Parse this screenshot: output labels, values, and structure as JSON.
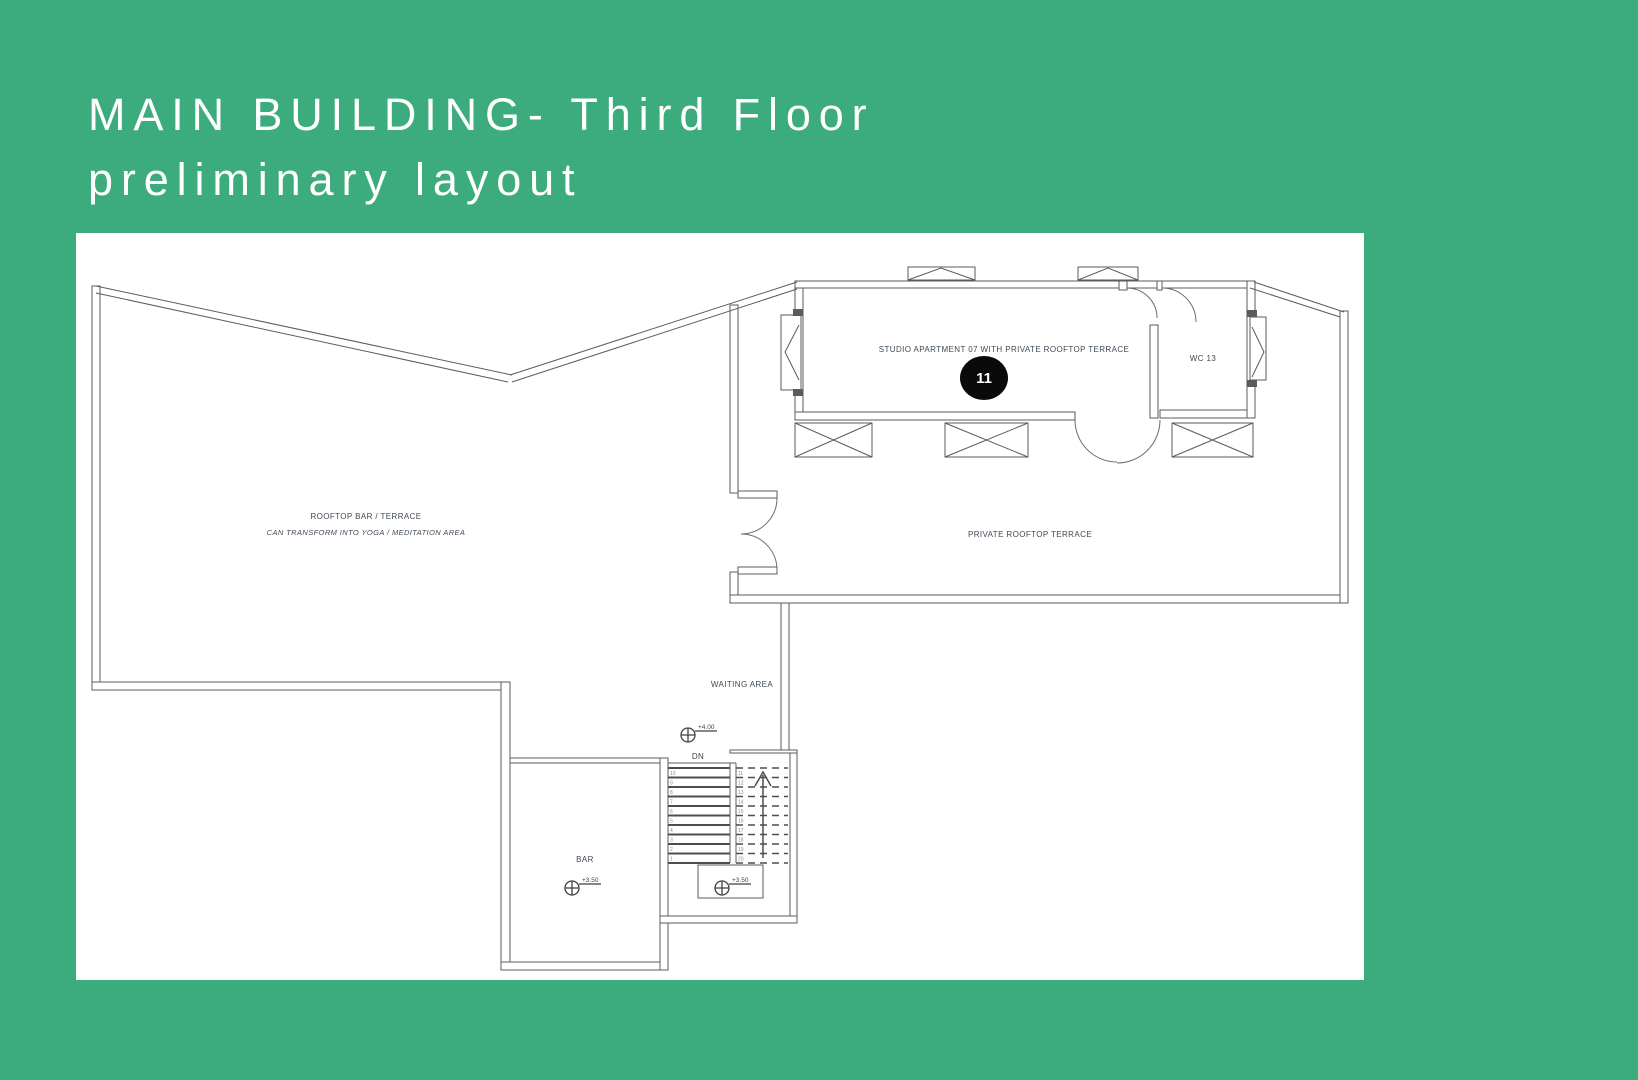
{
  "slide": {
    "title_line1": "MAIN BUILDING- Third Floor",
    "title_line2": "preliminary layout",
    "colors": {
      "background": "#3cab7e",
      "panel": "#ffffff",
      "line": "#5a5b5e",
      "label": "#3e4956",
      "badge": "#0a0a0a"
    }
  },
  "floor_plan": {
    "rooms": {
      "rooftop_bar": {
        "label": "ROOFTOP BAR / TERRACE",
        "sublabel": "CAN TRANSFORM INTO YOGA / MEDITATION AREA"
      },
      "studio": {
        "label": "STUDIO APARTMENT 07 WITH PRIVATE ROOFTOP TERRACE",
        "unit_badge": "11"
      },
      "wc": {
        "label": "WC 13"
      },
      "private_terrace": {
        "label": "PRIVATE ROOFTOP TERRACE"
      },
      "waiting_area": {
        "label": "WAITING AREA"
      },
      "bar": {
        "label": "BAR"
      }
    },
    "stairs": {
      "direction_label": "DN",
      "left_step_numbers": [
        "10",
        "9",
        "8",
        "7",
        "6",
        "5",
        "4",
        "3",
        "2",
        "1"
      ],
      "right_step_numbers": [
        "11",
        "12",
        "13",
        "14",
        "15",
        "16",
        "17",
        "18",
        "19",
        "20"
      ]
    },
    "elevation_markers": [
      {
        "label": "+4.00"
      },
      {
        "label": "+3.50"
      },
      {
        "label": "+3.50"
      }
    ]
  }
}
